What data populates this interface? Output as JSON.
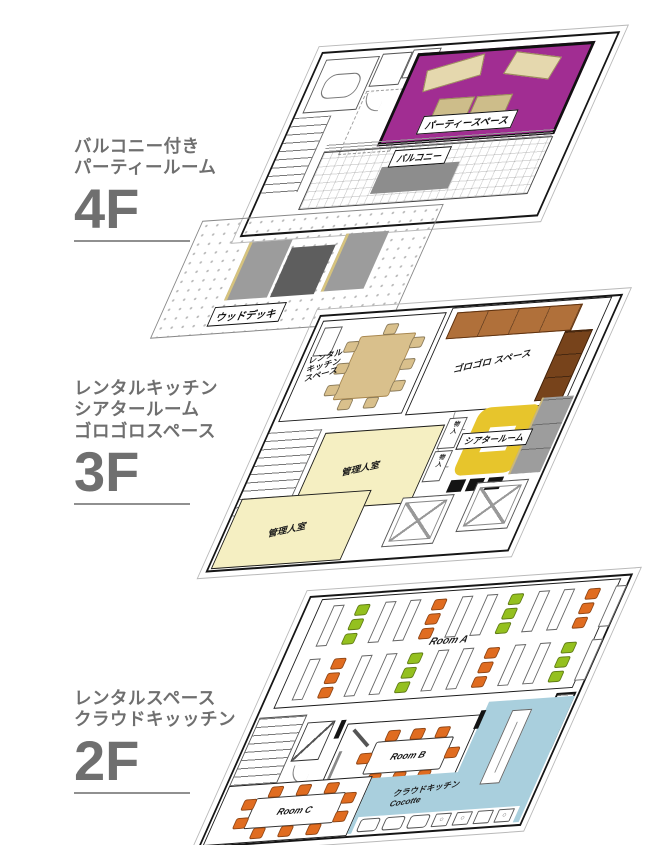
{
  "colors": {
    "purple": "#a12d92",
    "yellow": "#e7c52c",
    "cream": "#f5efc2",
    "brown": "#b0703a",
    "brown_dark": "#77431b",
    "blue": "#a9cfdd",
    "orange": "#e06c20",
    "green": "#94c01f",
    "tan": "#d9c08c",
    "label_gray": "#6f6f6f"
  },
  "floors": [
    {
      "number": "4F",
      "title_lines": [
        "バルコニー付き",
        "パーティールーム"
      ],
      "areas": {
        "party": "パーティースペース",
        "balcony": "バルコニー",
        "wood_deck": "ウッドデッキ"
      }
    },
    {
      "number": "3F",
      "title_lines": [
        "レンタルキッチン",
        "シアタールーム",
        "ゴロゴロスペース"
      ],
      "areas": {
        "rental_kitchen_lines": [
          "レンタル",
          "キッチン",
          "スペース"
        ],
        "gorogoro": "ゴロゴロ スペース",
        "theater": "シアタールーム",
        "caretaker": "管理人室",
        "storage": "物入"
      },
      "kitchen_chairs": {
        "top": 1,
        "bottom": 2,
        "left": 3,
        "right": 3,
        "color": "tan"
      }
    },
    {
      "number": "2F",
      "title_lines": [
        "レンタルスペース",
        "クラウドキッッチン"
      ],
      "areas": {
        "room_a": "Room A",
        "room_b": "Room B",
        "room_c": "Room C",
        "cloud_kitchen": "クラウドキッチン",
        "cloud_kitchen_sub": "Cocotte"
      },
      "room_a_layout": {
        "rows": 2,
        "groups_per_row": 4,
        "chairs_per_group": 3,
        "row_colors": [
          [
            "green",
            "orange",
            "green",
            "orange"
          ],
          [
            "orange",
            "green",
            "orange",
            "green"
          ]
        ]
      },
      "room_b_chairs": {
        "top": 3,
        "bottom": 3,
        "left": 1,
        "right": 1,
        "color": "orange"
      },
      "room_c_chairs": {
        "top": 3,
        "bottom": 3,
        "left": 2,
        "right": 2,
        "color": "orange"
      }
    }
  ]
}
